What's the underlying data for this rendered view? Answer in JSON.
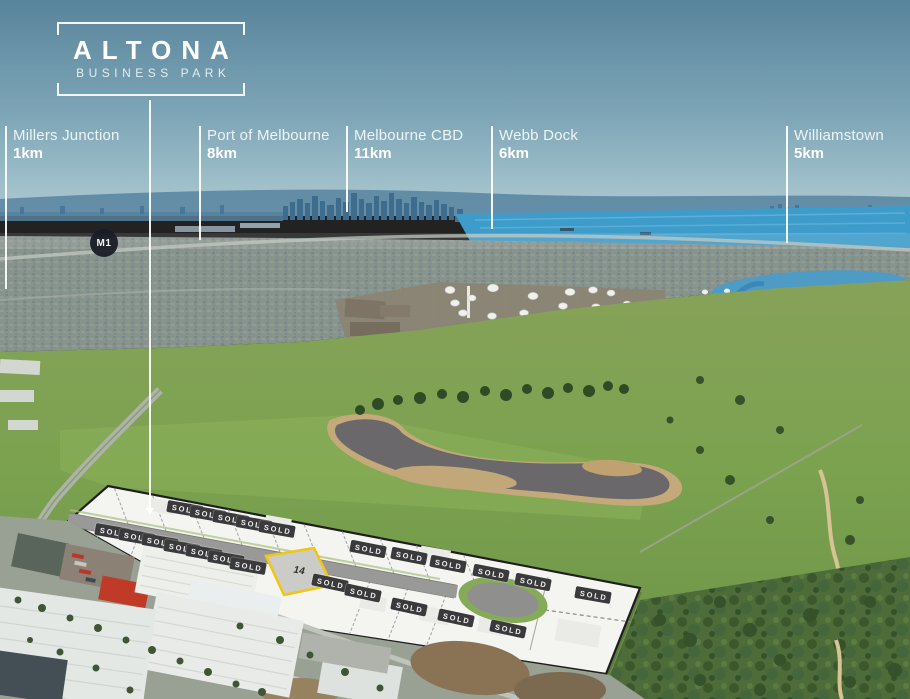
{
  "logo": {
    "title": "ALTONA",
    "subtitle": "BUSINESS PARK"
  },
  "logo_line": {
    "x": 149,
    "top": 100,
    "bottom": 508
  },
  "landmarks": [
    {
      "name": "Millers Junction",
      "distance": "1km",
      "line_x": 5,
      "line_top": 126,
      "line_bottom": 289
    },
    {
      "name": "Port of Melbourne",
      "distance": "8km",
      "line_x": 199,
      "line_top": 126,
      "line_bottom": 240
    },
    {
      "name": "Melbourne CBD",
      "distance": "11km",
      "line_x": 346,
      "line_top": 126,
      "line_bottom": 212
    },
    {
      "name": "Webb Dock",
      "distance": "6km",
      "line_x": 491,
      "line_top": 126,
      "line_bottom": 229
    },
    {
      "name": "Williamstown",
      "distance": "5km",
      "line_x": 786,
      "line_top": 126,
      "line_bottom": 243
    }
  ],
  "road_badge": {
    "label": "M1"
  },
  "site_plan": {
    "sold_label": "SOLD",
    "highlight_lot": {
      "number": "14"
    },
    "sold_badges": [
      {
        "x": 185,
        "y": 509,
        "rot": 10
      },
      {
        "x": 208,
        "y": 514,
        "rot": 10
      },
      {
        "x": 231,
        "y": 519,
        "rot": 10
      },
      {
        "x": 254,
        "y": 524,
        "rot": 10
      },
      {
        "x": 277,
        "y": 529,
        "rot": 10
      },
      {
        "x": 368,
        "y": 549,
        "rot": 11
      },
      {
        "x": 409,
        "y": 556,
        "rot": 11
      },
      {
        "x": 448,
        "y": 564,
        "rot": 11
      },
      {
        "x": 491,
        "y": 573,
        "rot": 11
      },
      {
        "x": 533,
        "y": 582,
        "rot": 11
      },
      {
        "x": 593,
        "y": 595,
        "rot": 10
      },
      {
        "x": 113,
        "y": 532,
        "rot": 10
      },
      {
        "x": 137,
        "y": 537,
        "rot": 10
      },
      {
        "x": 160,
        "y": 542,
        "rot": 10
      },
      {
        "x": 182,
        "y": 548,
        "rot": 10
      },
      {
        "x": 204,
        "y": 553,
        "rot": 10
      },
      {
        "x": 226,
        "y": 559,
        "rot": 10
      },
      {
        "x": 248,
        "y": 566,
        "rot": 10
      },
      {
        "x": 330,
        "y": 583,
        "rot": 12
      },
      {
        "x": 363,
        "y": 593,
        "rot": 12
      },
      {
        "x": 409,
        "y": 607,
        "rot": 12
      },
      {
        "x": 456,
        "y": 618,
        "rot": 12
      },
      {
        "x": 508,
        "y": 629,
        "rot": 12
      }
    ]
  },
  "colors": {
    "accent_yellow": "#F2C50F",
    "sold_badge": "#3A3A3C",
    "bay_water": "#3E9CCB",
    "plan_white": "#F4F4F1",
    "label_text": "#FFFFFF"
  }
}
